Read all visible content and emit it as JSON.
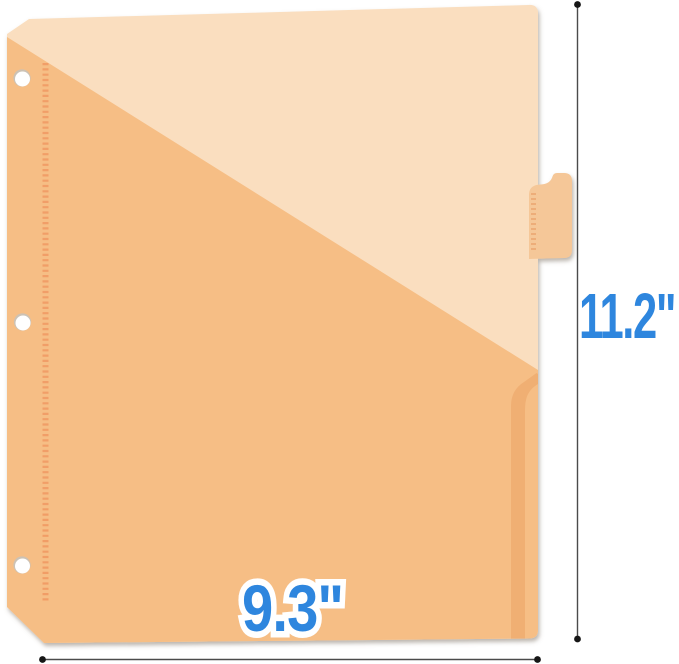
{
  "labels": {
    "height": "11.2\"",
    "width": "9.3\""
  },
  "colors": {
    "background": "#FFFFFF",
    "sheet": "#FADEBF",
    "pocket": "#F6BE85",
    "pocket_fold": "#EDA96E",
    "tab": "#F5C798",
    "stitch": "#F0965F",
    "tab_stitch": "#E9A06A",
    "hole_fill": "#FFFFFF",
    "hole_rim": "#CCC2B5",
    "dimension_line": "#4B4B4B",
    "dimension_dot": "#161616",
    "label_blue": "#2E86DE",
    "label_outline": "#FFFFFF"
  }
}
